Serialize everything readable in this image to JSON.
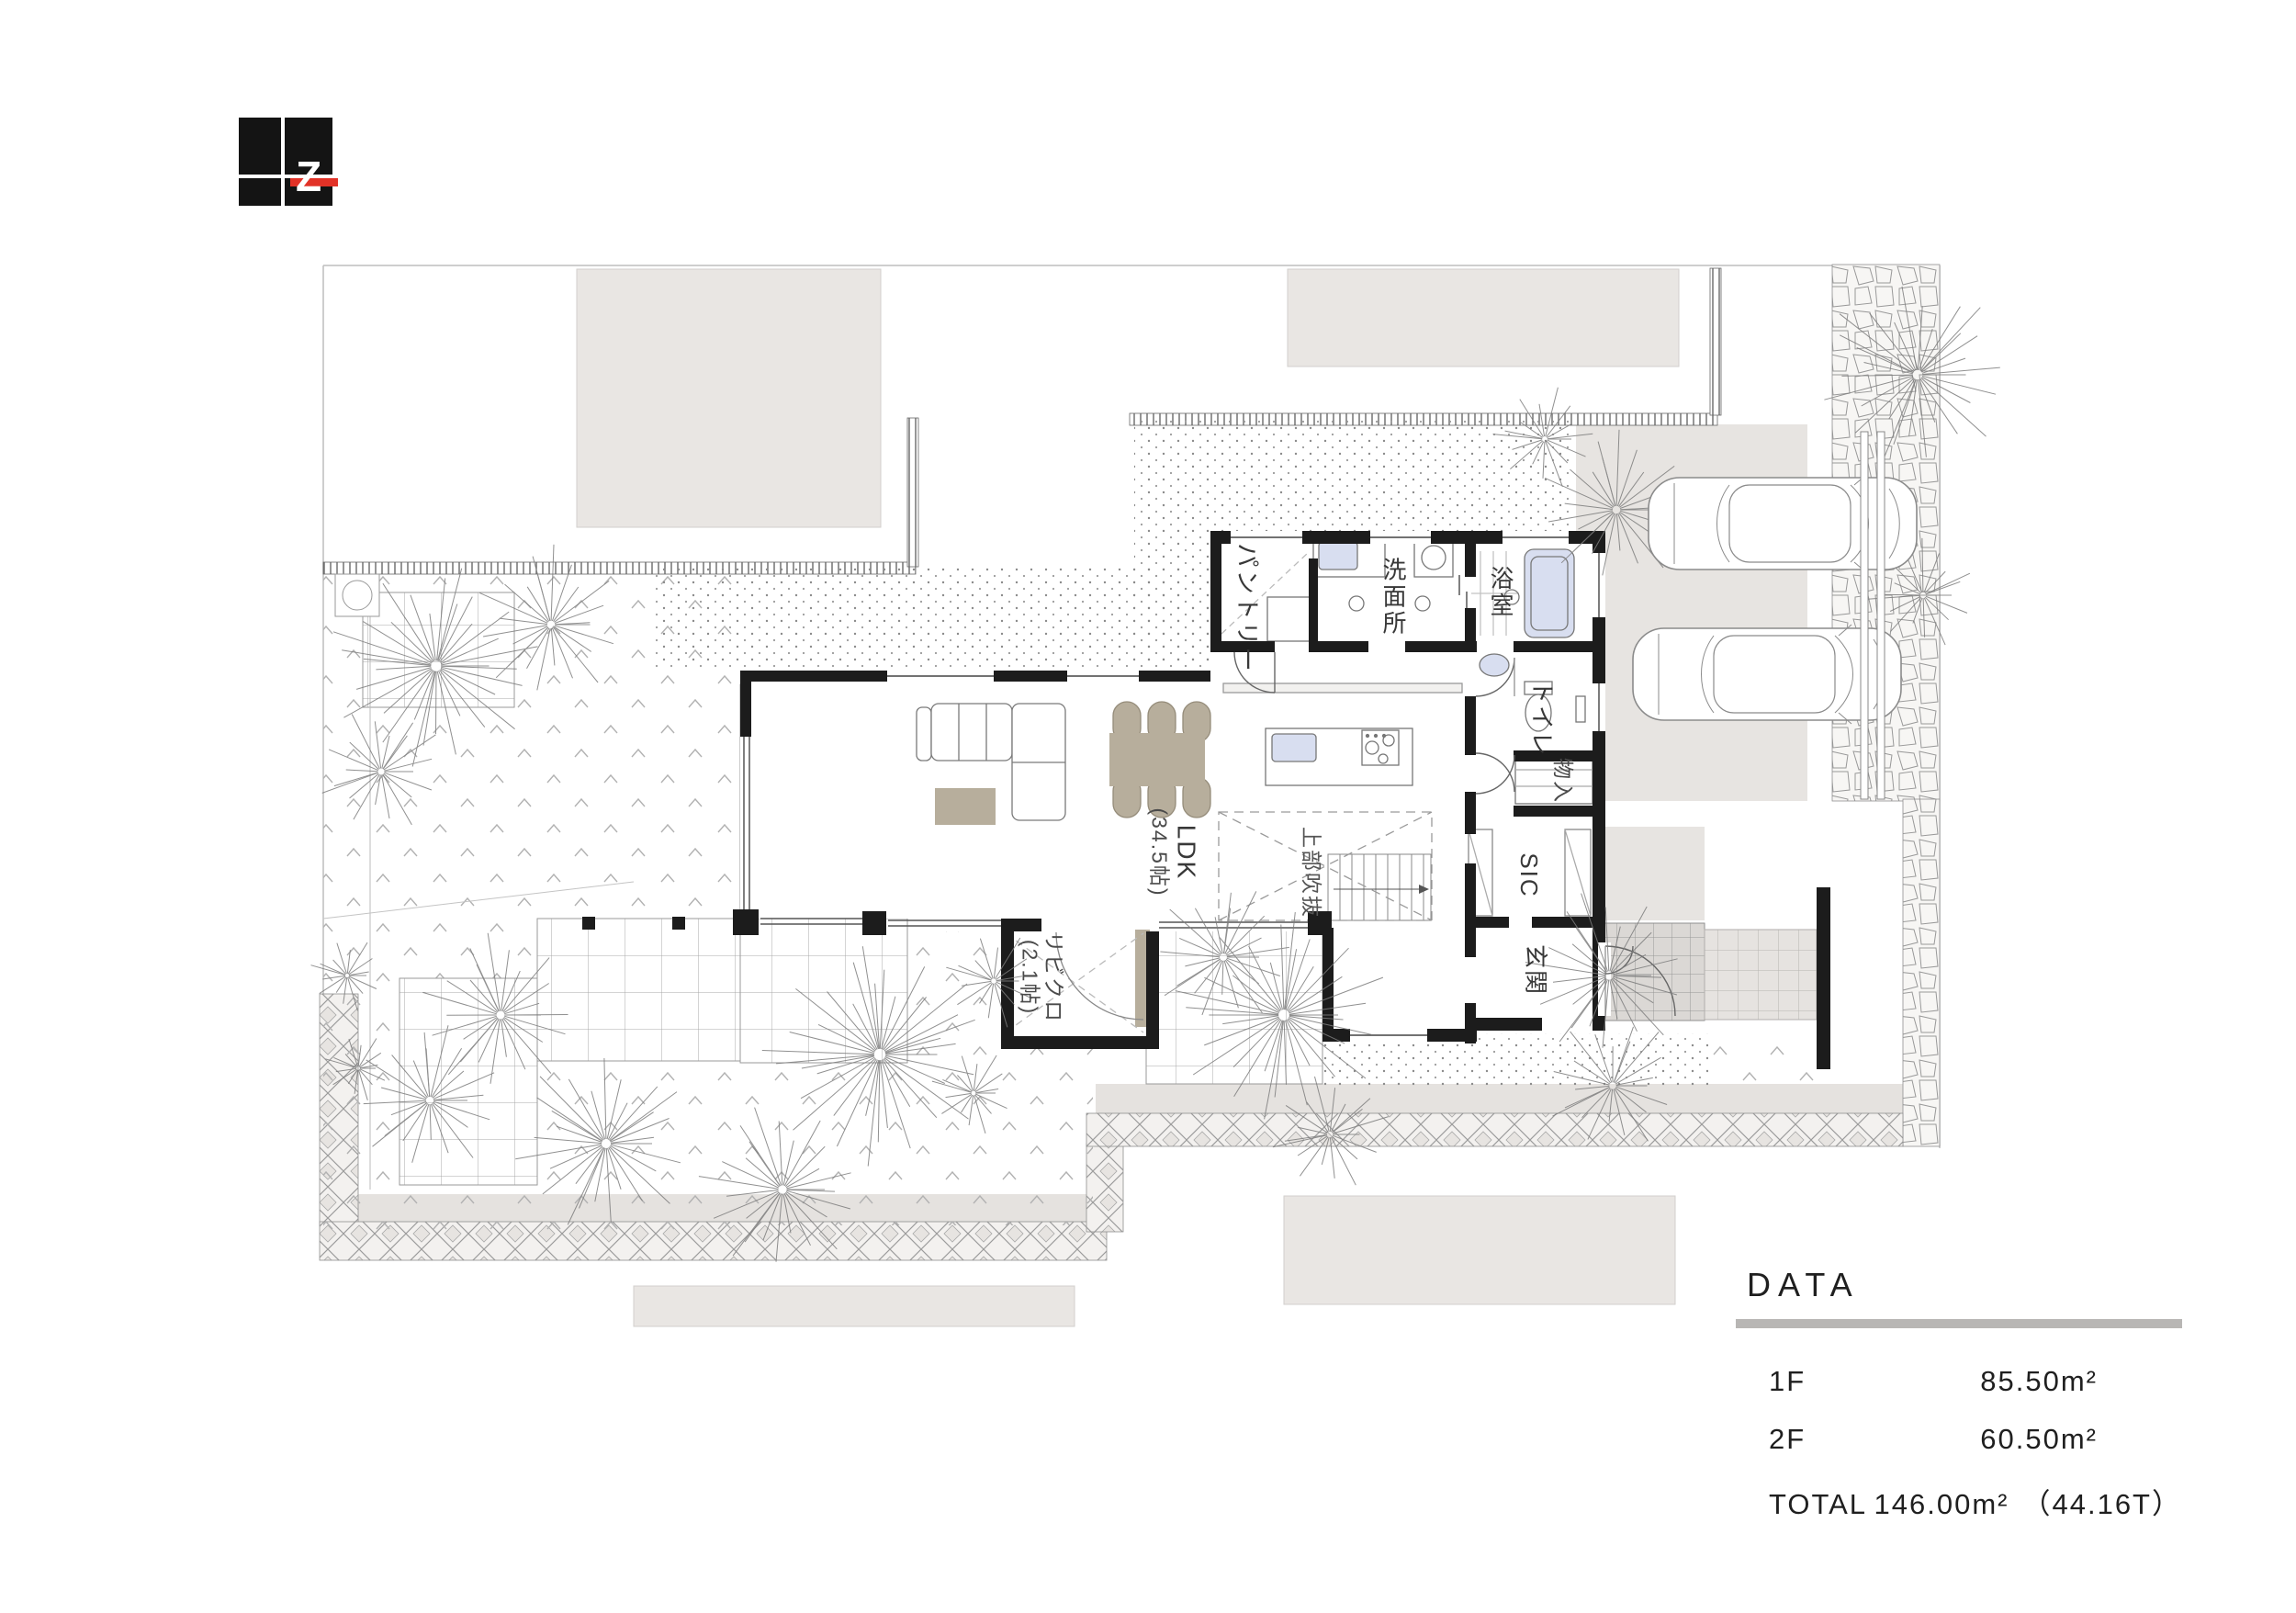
{
  "logo": {
    "letter": "Z"
  },
  "colors": {
    "logo_red": "#e23227",
    "logo_black": "#141414",
    "wall": "#1c1c1c",
    "tan": "#b7ae9c",
    "fixture_blue": "#d8def0",
    "neighbor": "#e9e6e3",
    "accent_gray": "#b8b6b4"
  },
  "rooms": {
    "pantry": "パントリー",
    "washroom": "洗面所",
    "bathroom": "浴室",
    "toilet": "トイレ",
    "storage": "物入",
    "shoe_closet": "SIC",
    "entrance": "玄関",
    "ldk_name": "LDK",
    "ldk_size": "(34.5帖)",
    "living_closet_name": "リビクロ",
    "living_closet_size": "(2.1帖)",
    "void_above": "上部吹抜"
  },
  "data_panel": {
    "title": "DATA",
    "rows": [
      {
        "label": "1F",
        "value": "85.50m²",
        "extra": ""
      },
      {
        "label": "2F",
        "value": "60.50m²",
        "extra": ""
      },
      {
        "label": "TOTAL",
        "value": "146.00m²",
        "extra": "（44.16T）"
      }
    ]
  }
}
